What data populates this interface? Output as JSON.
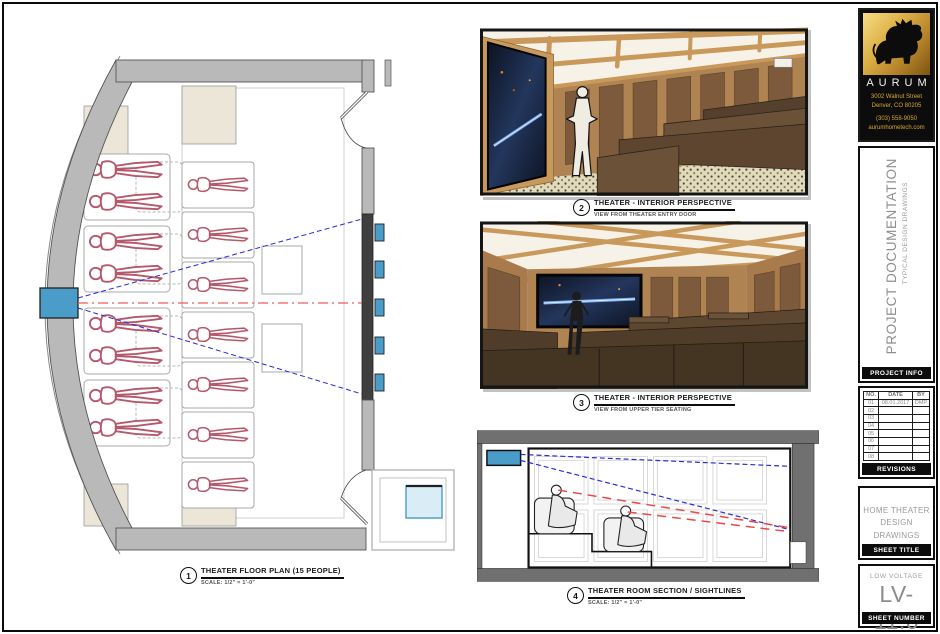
{
  "callouts": [
    {
      "number": "1",
      "title": "THEATER FLOOR PLAN (15 PEOPLE)",
      "subtitle": "SCALE:  1/2\" = 1'-0\""
    },
    {
      "number": "2",
      "title": "THEATER - INTERIOR PERSPECTIVE",
      "subtitle": "VIEW FROM THEATER ENTRY DOOR"
    },
    {
      "number": "3",
      "title": "THEATER - INTERIOR PERSPECTIVE",
      "subtitle": "VIEW FROM UPPER TIER SEATING"
    },
    {
      "number": "4",
      "title": "THEATER ROOM SECTION / SIGHTLINES",
      "subtitle": "SCALE:  1/2\" = 1'-0\""
    }
  ],
  "title_block": {
    "logo": {
      "company": "AURUM",
      "address_line1": "3002 Walnut Street",
      "address_line2": "Denver, CO 80205",
      "phone": "(303) 558-9050",
      "website": "aurumhometech.com",
      "icon": "bull-icon"
    },
    "project_info": {
      "title": "PROJECT DOCUMENTATION",
      "subtitle": "TYPICAL DESIGN DRAWINGS",
      "label": "PROJECT INFO"
    },
    "revisions": {
      "headers": [
        "NO.",
        "DATE",
        "BY"
      ],
      "rows": [
        [
          "01",
          "08.01.2017",
          "DMP"
        ],
        [
          "02",
          "",
          ""
        ],
        [
          "03",
          "",
          ""
        ],
        [
          "04",
          "",
          ""
        ],
        [
          "05",
          "",
          ""
        ],
        [
          "06",
          "",
          ""
        ],
        [
          "07",
          "",
          ""
        ],
        [
          "08",
          "",
          ""
        ]
      ],
      "label": "REVISIONS"
    },
    "sheet_title": {
      "line1": "HOME THEATER",
      "line2": "DESIGN DRAWINGS",
      "label": "SHEET TITLE"
    },
    "sheet_number": {
      "category": "LOW VOLTAGE",
      "number": "LV-11.0",
      "label": "SHEET NUMBER"
    }
  },
  "colors": {
    "logo_gold": "#d8a832",
    "accent_blue": "#4a9cc9",
    "sightline_blue": "#2a2ad8",
    "sightline_red": "#e84848",
    "figure_red": "#b5586c",
    "wall_gray": "#b9b9b9",
    "screen_band": "#3f3f3f",
    "wood": "#c9995c",
    "seat_brown": "#4e3b29"
  }
}
